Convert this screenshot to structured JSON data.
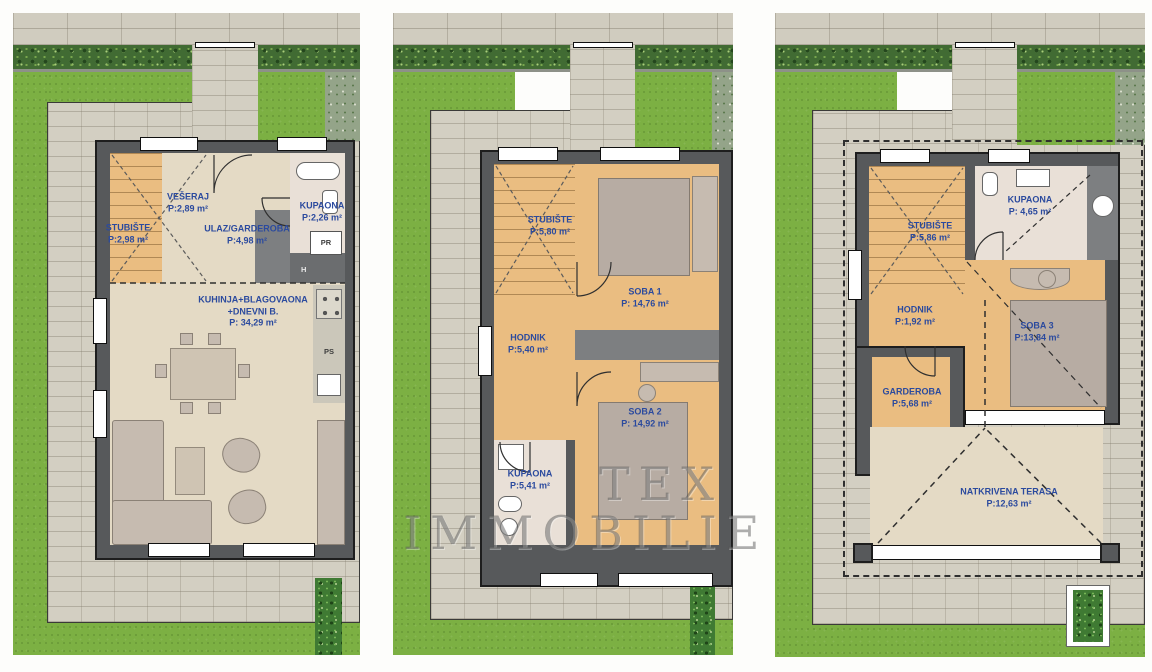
{
  "watermark": {
    "line1": "TEX",
    "line2": "IMMOBILIE"
  },
  "colors": {
    "label_blue": "#2b4a9e",
    "wall_gray": "#57595b",
    "floor_tan": "#eabd81",
    "floor_beige": "#e4dac5",
    "grass_green": "#7cb043"
  },
  "panels": [
    {
      "floor": "ground",
      "rooms": [
        {
          "name": "VEŠERAJ",
          "area": "P:2,89 m²"
        },
        {
          "name": "STUBIŠTE",
          "area": "P:2,98 m²"
        },
        {
          "name": "ULAZ/GARDEROBA",
          "area": "P:4,98 m²"
        },
        {
          "name": "KUPAONA",
          "area": "P:2,26 m²"
        },
        {
          "name": "KUHINJA+BLAGOVAONA",
          "name2": "+DNEVNI B.",
          "area": "P: 34,29 m²"
        }
      ],
      "tags": [
        "PR",
        "H",
        "PS"
      ]
    },
    {
      "floor": "first",
      "rooms": [
        {
          "name": "STUBIŠTE",
          "area": "P:5,80 m²"
        },
        {
          "name": "SOBA 1",
          "area": "P: 14,76 m²"
        },
        {
          "name": "HODNIK",
          "area": "P:5,40 m²"
        },
        {
          "name": "SOBA 2",
          "area": "P: 14,92 m²"
        },
        {
          "name": "KUPAONA",
          "area": "P:5,41 m²"
        }
      ],
      "tags": []
    },
    {
      "floor": "attic",
      "rooms": [
        {
          "name": "STUBIŠTE",
          "area": "P:5,86 m²"
        },
        {
          "name": "KUPAONA",
          "area": "P: 4,65 m²"
        },
        {
          "name": "HODNIK",
          "area": "P:1,92 m²"
        },
        {
          "name": "SOBA 3",
          "area": "P:13,84 m²"
        },
        {
          "name": "GARDEROBA",
          "area": "P:5,68 m²"
        },
        {
          "name": "NATKRIVENA TERASA",
          "area": "P:12,63 m²"
        }
      ],
      "tags": []
    }
  ]
}
